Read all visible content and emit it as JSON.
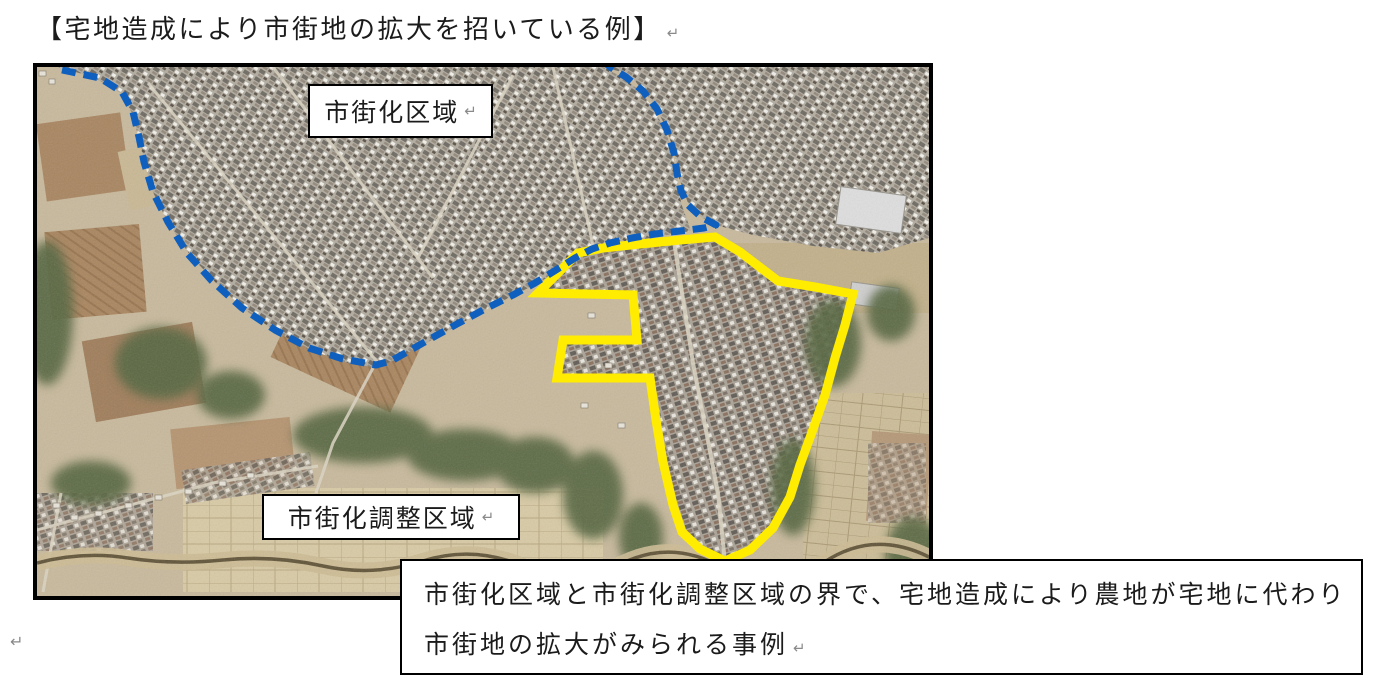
{
  "page": {
    "title": "【宅地造成により市街地の拡大を招いている例】",
    "return_mark": "↵"
  },
  "photo": {
    "label_top": "市街化区域",
    "label_bottom": "市街化調整区域",
    "caption_line1": "市街化区域と市街化調整区域の界で、宅地造成により農地が宅地に代わり",
    "caption_line2": "市街地の拡大がみられる事例"
  },
  "colors": {
    "boundary_blue": "#0e5fbe",
    "highlight_yellow": "#ffec00"
  }
}
